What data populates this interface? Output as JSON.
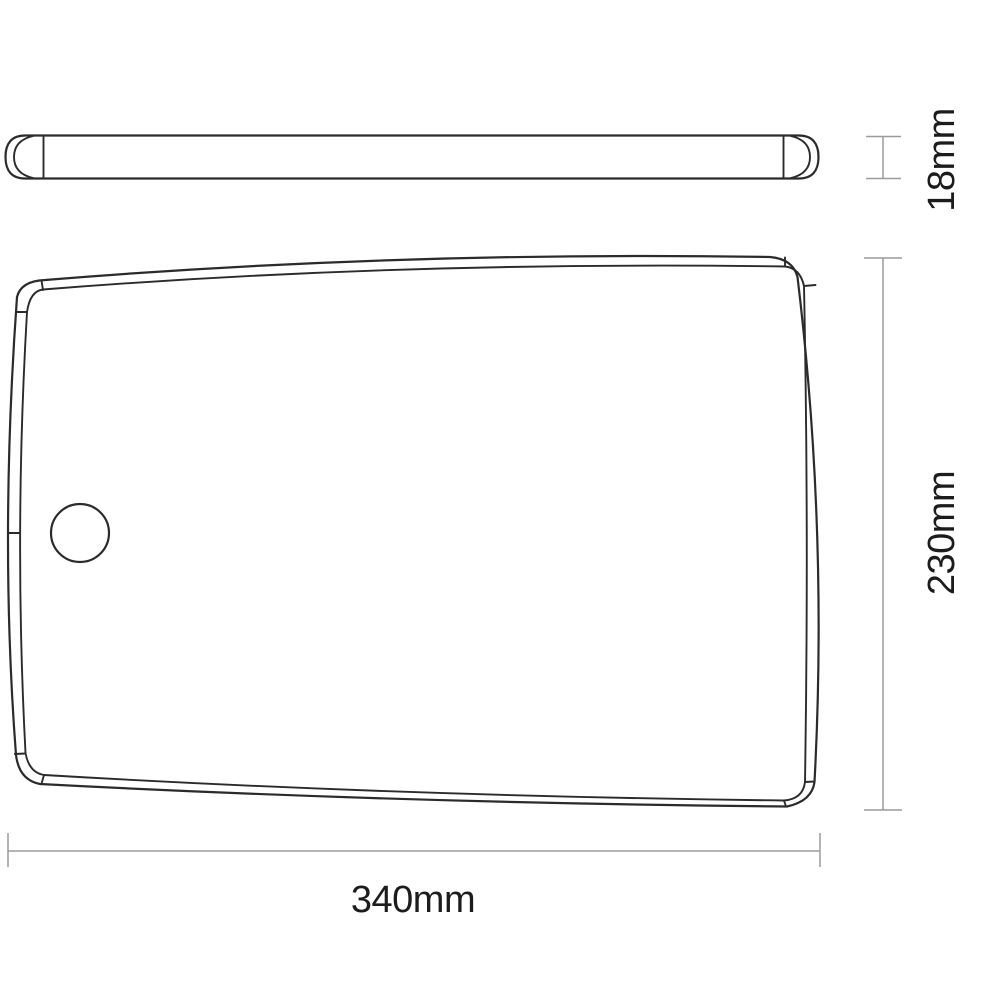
{
  "drawing": {
    "type": "technical-dimension-drawing",
    "subject": "flat board panel with thumb hole, side profile view and plan view",
    "labels": {
      "thickness": "18mm",
      "height": "230mm",
      "width": "340mm"
    },
    "colors": {
      "outline": "#2b2b2b",
      "dimension": "#9b9b9b",
      "text": "#1c1c1c",
      "background": "#ffffff"
    }
  }
}
